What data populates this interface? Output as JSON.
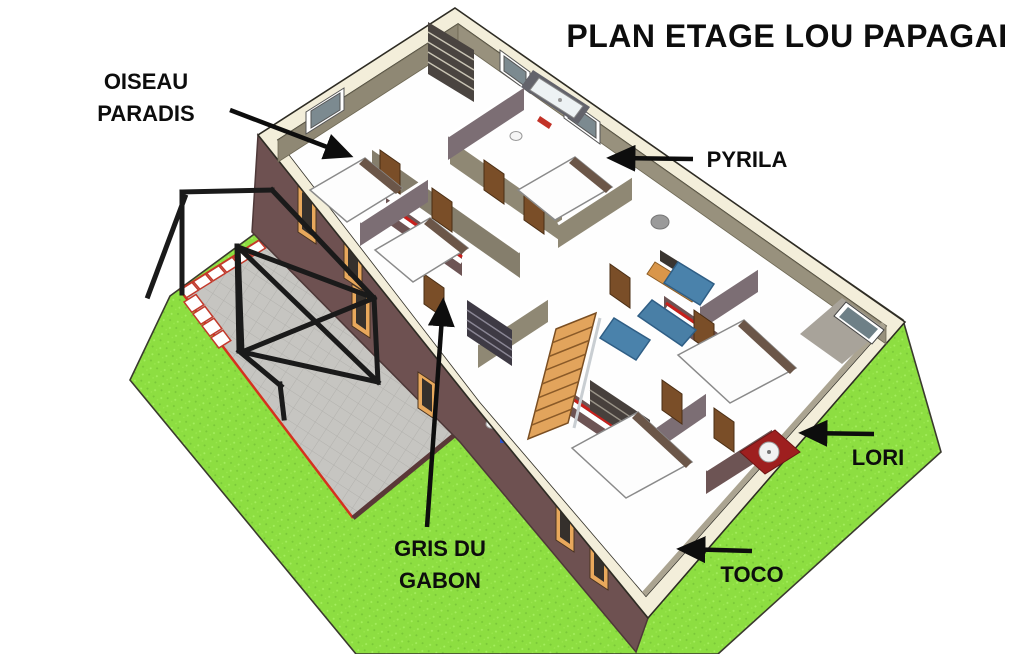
{
  "title": "PLAN ETAGE LOU PAPAGAI",
  "labels": {
    "oiseau": {
      "line1": "OISEAU",
      "line2": "PARADIS"
    },
    "pyrila": "PYRILA",
    "lori": "LORI",
    "toco": "TOCO",
    "gris": {
      "line1": "GRIS DU",
      "line2": "GABON"
    }
  },
  "rooms": [
    "OISEAU PARADIS",
    "PYRILA",
    "LORI",
    "TOCO",
    "GRIS DU GABON"
  ],
  "palette": {
    "lawn_green": "#8DDE41",
    "lawn_light": "#A5EF5E",
    "terrace_gray": "#C6C5C1",
    "planter_red": "#D5311F",
    "wall_band_cream": "#F3EEDA",
    "facade_maroon": "#6E5151",
    "interior_wall_olive": "#8F8874",
    "interior_wall_mauve": "#7C6E74",
    "interior_wall_maroon": "#6D5454",
    "accent_red": "#C8201C",
    "door_brown": "#7A4E28",
    "stairs_orange": "#E2A45C",
    "sofa_blue": "#497FA6",
    "cabinet_red": "#9E1F1F",
    "floor_white": "#FEFEFE",
    "pergola_black": "#1A1A1A",
    "text_black": "#0D0D0D"
  }
}
